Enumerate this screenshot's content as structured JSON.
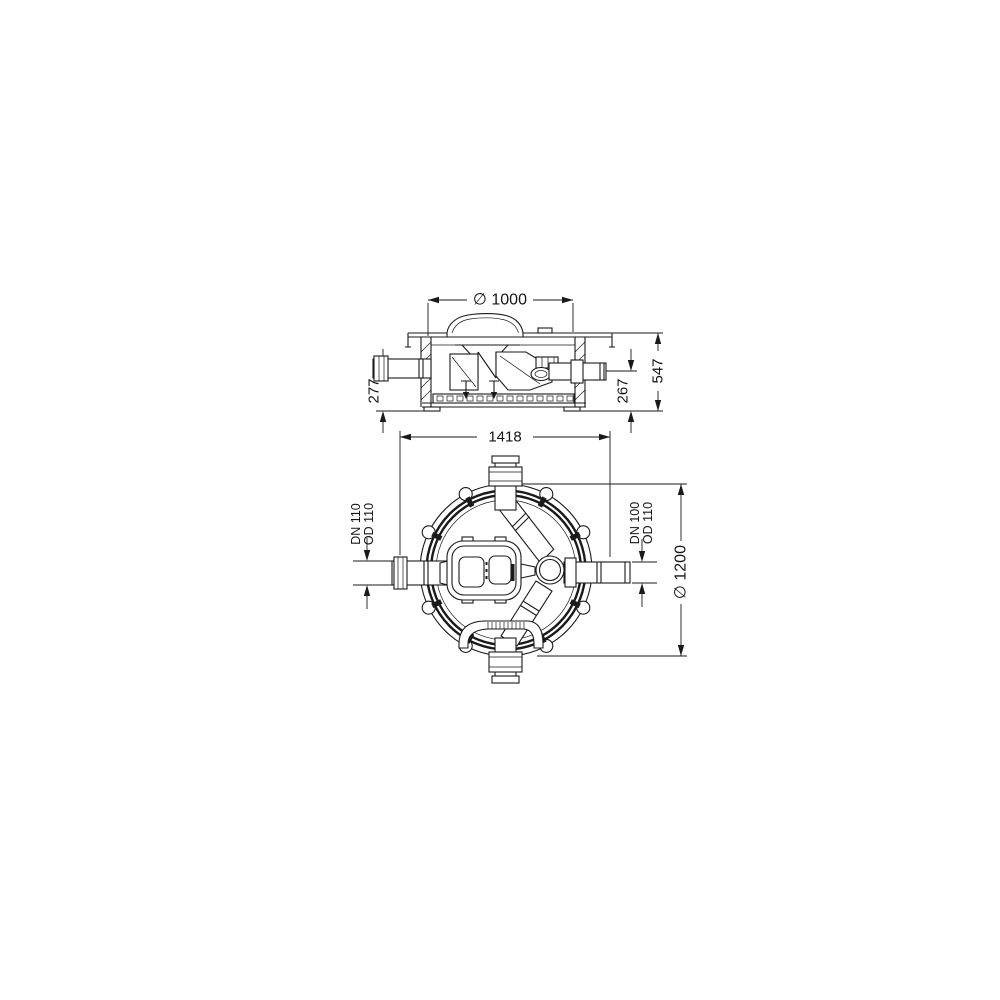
{
  "colors": {
    "line": "#1a1a1a",
    "background": "#ffffff"
  },
  "drawing": {
    "side_view": {
      "dims": {
        "cover_diameter": "∅ 1000",
        "left_invert": "277",
        "right_invert": "267",
        "total_height": "547"
      }
    },
    "plan_view": {
      "dims": {
        "overall_width": "1418",
        "chamber_diameter": "∅ 1200",
        "left_pipe": [
          "DN 110",
          "OD 110"
        ],
        "right_pipe": [
          "DN 100",
          "OD 110"
        ]
      }
    }
  }
}
